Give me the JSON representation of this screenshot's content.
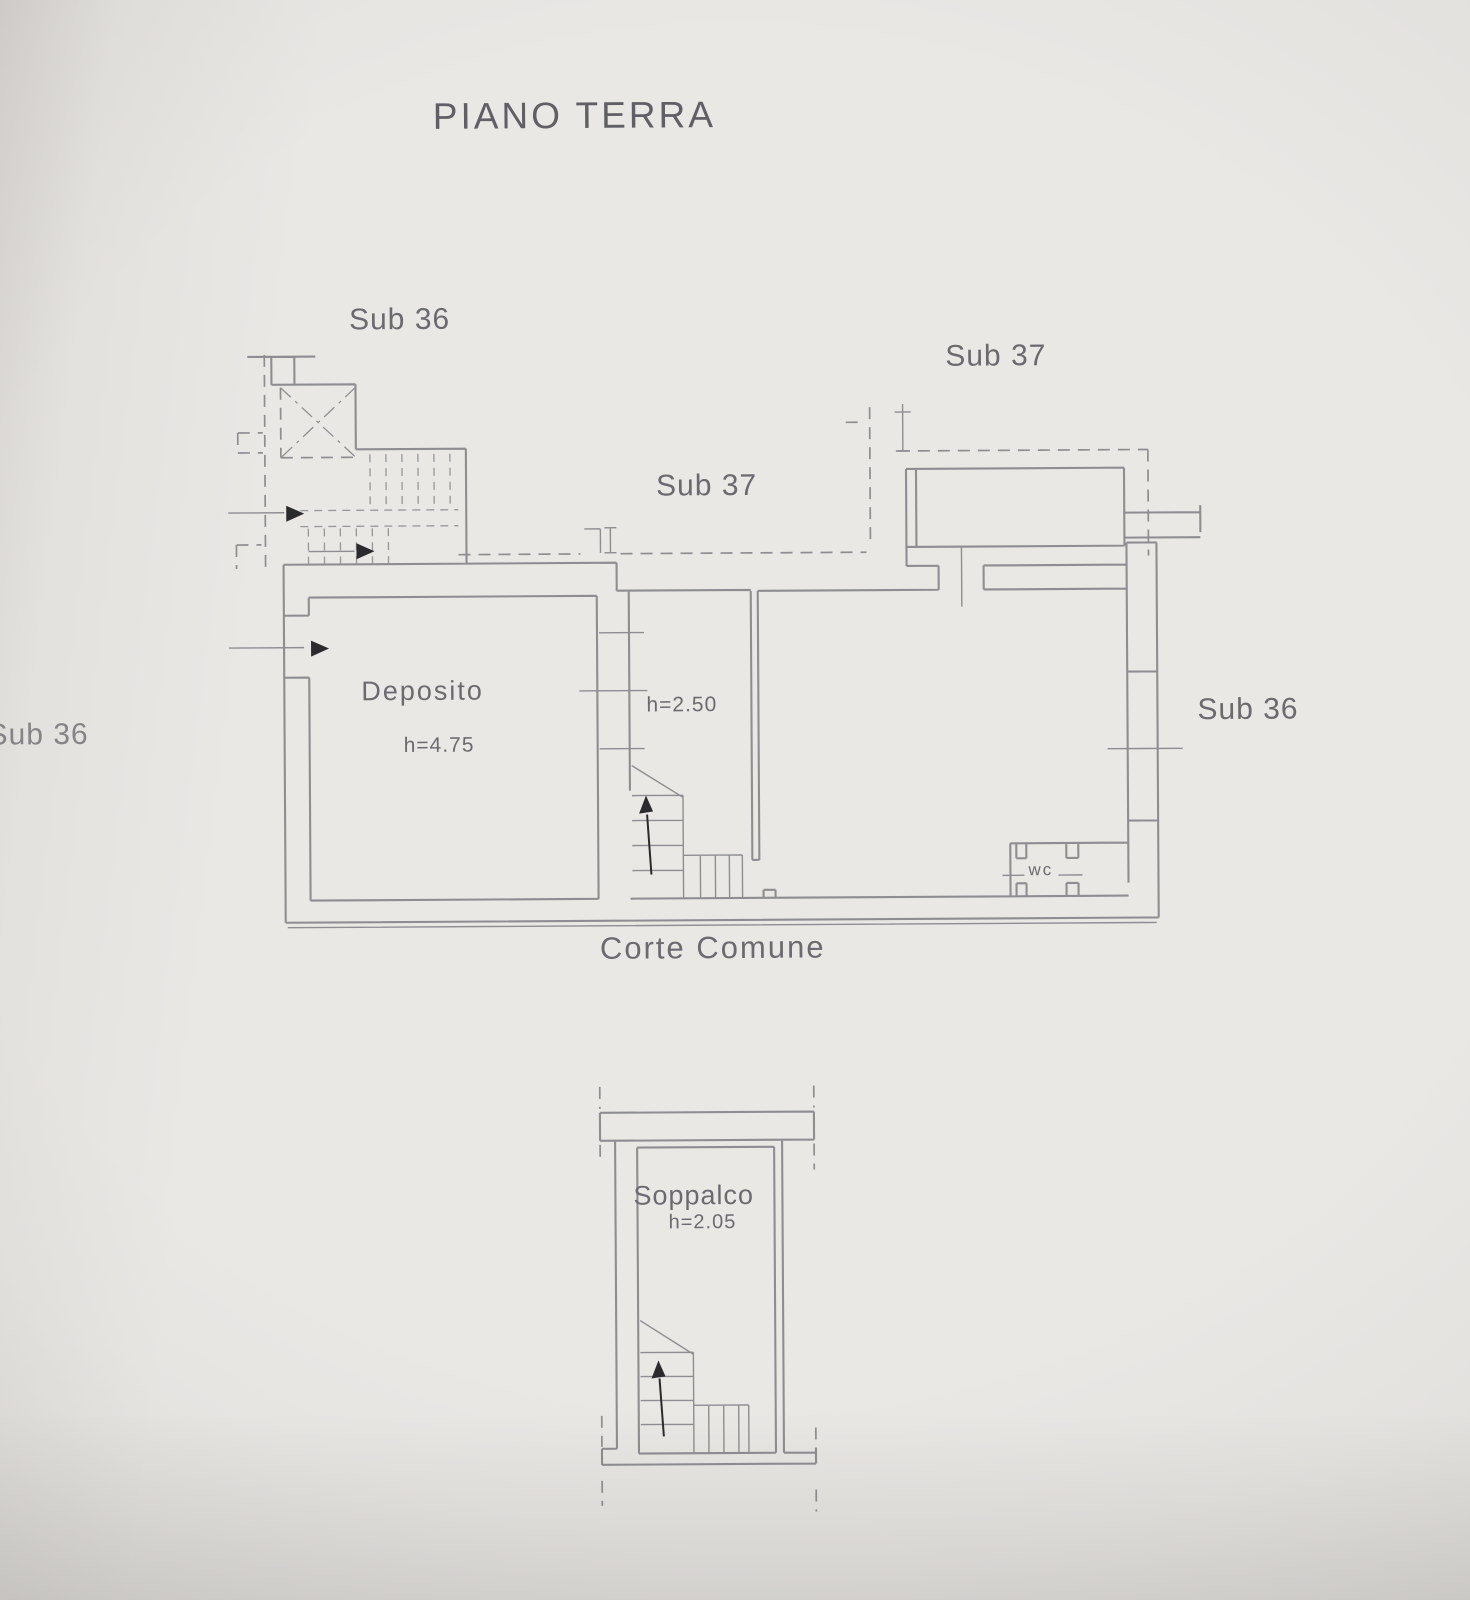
{
  "document": {
    "floor_title": "PIANO TERRA"
  },
  "ground_floor_plan": {
    "cadastral_labels": {
      "sub36_stairwell": "Sub 36",
      "sub37_upper": "Sub 37",
      "sub37_corridor": "Sub 37",
      "sub36_right": "Sub 36",
      "sub36_left": "Sub 36"
    },
    "rooms": {
      "deposito": {
        "name": "Deposito",
        "height": "h=4.75"
      },
      "central_room": {
        "height": "h=2.50"
      },
      "wc": {
        "name": "wc"
      }
    },
    "courtyard_label": "Corte Comune"
  },
  "mezzanine_plan": {
    "room": {
      "name": "Soppalco",
      "height": "h=2.05"
    }
  },
  "colors": {
    "paper": "#eae8e5",
    "paper-edge": "#d6d4d1",
    "line": "#8e8d92",
    "text": "#6b6a70",
    "arrow": "#2b2b2f"
  }
}
